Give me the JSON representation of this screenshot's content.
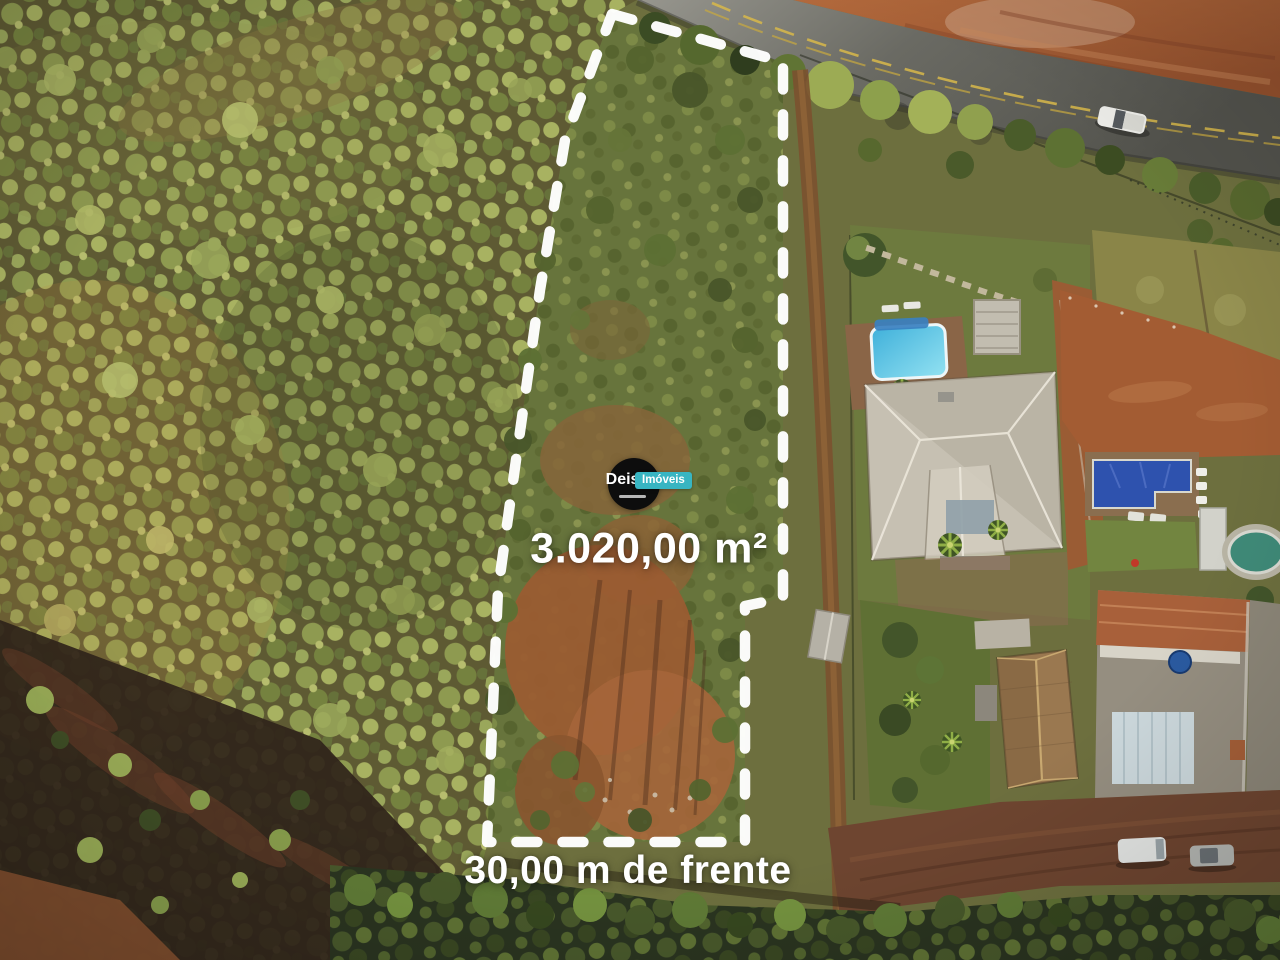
{
  "overlay": {
    "area_label": "3.020,00 m²",
    "frontage_label": "30,00 m de frente"
  },
  "logo": {
    "name": "Deise",
    "suffix": "Imóveis"
  },
  "colors": {
    "boundary_dash": "#ffffff",
    "label_text": "#ffffff",
    "logo_circle_bg": "#0d0d0d",
    "logo_chip_bg": "#38b5c2",
    "pool_a_water": "#45bede",
    "pool_b_cover": "#2e52ae",
    "road_asphalt": "#5d5d56",
    "red_field": "#a35c33"
  }
}
